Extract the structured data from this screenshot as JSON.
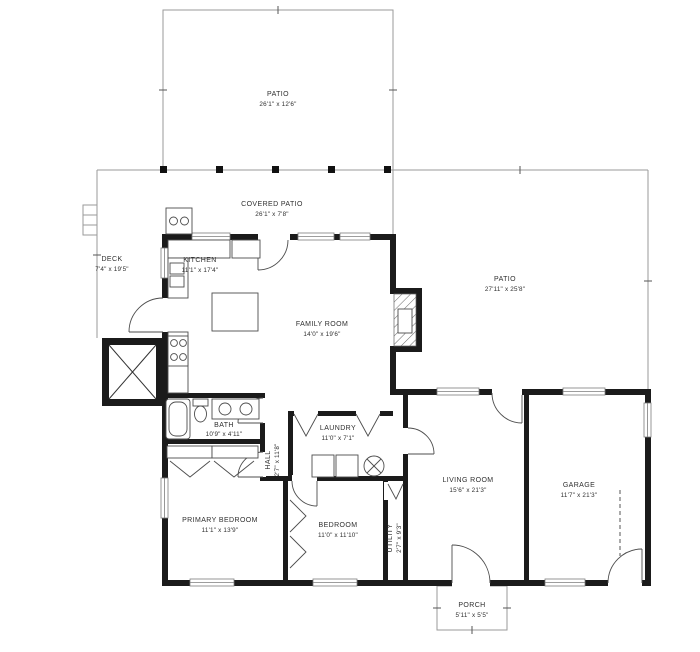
{
  "plan": {
    "title": "Single-story house floor plan",
    "rooms": [
      {
        "id": "patio-top",
        "name": "PATIO",
        "dims": "26'1\" x 12'6\""
      },
      {
        "id": "covered-patio",
        "name": "COVERED PATIO",
        "dims": "26'1\" x 7'8\""
      },
      {
        "id": "deck",
        "name": "DECK",
        "dims": "7'4\" x 19'5\""
      },
      {
        "id": "kitchen",
        "name": "KITCHEN",
        "dims": "11'1\" x 17'4\""
      },
      {
        "id": "family-room",
        "name": "FAMILY ROOM",
        "dims": "14'0\" x 19'6\""
      },
      {
        "id": "patio-right",
        "name": "PATIO",
        "dims": "27'11\" x 25'8\""
      },
      {
        "id": "bath",
        "name": "BATH",
        "dims": "10'9\" x 4'11\""
      },
      {
        "id": "laundry",
        "name": "LAUNDRY",
        "dims": "11'0\" x 7'1\""
      },
      {
        "id": "hall",
        "name": "HALL",
        "dims": "2'7\" x 11'8\""
      },
      {
        "id": "primary-bedroom",
        "name": "PRIMARY BEDROOM",
        "dims": "11'1\" x 13'9\""
      },
      {
        "id": "bedroom",
        "name": "BEDROOM",
        "dims": "11'0\" x 11'10\""
      },
      {
        "id": "utility",
        "name": "UTILITY",
        "dims": "2'7\" x 9'3\""
      },
      {
        "id": "living-room",
        "name": "LIVING ROOM",
        "dims": "15'6\" x 21'3\""
      },
      {
        "id": "garage",
        "name": "GARAGE",
        "dims": "11'7\" x 21'3\""
      },
      {
        "id": "porch",
        "name": "PORCH",
        "dims": "5'11\" x 5'5\""
      }
    ],
    "colors": {
      "wall": "#1b1b1b",
      "outdoor_outline": "#9a9a9a",
      "label_text": "#2f2f2f",
      "background": "#ffffff"
    }
  }
}
